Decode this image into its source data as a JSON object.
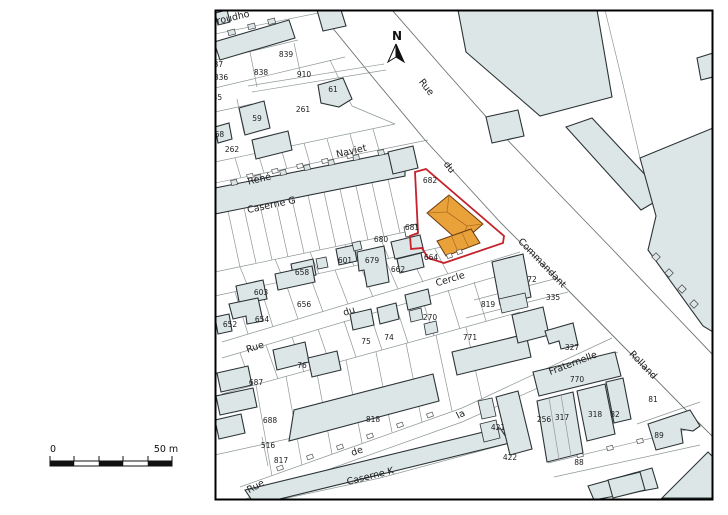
{
  "map": {
    "north_indicator": {
      "label": "N"
    },
    "scale_bar": {
      "zero_label": "0",
      "max_label": "50 m"
    },
    "colors": {
      "building_fill": "#dce6e6",
      "building_outline": "#2c3336",
      "parcel_line": "#8e9797",
      "road_line": "#6a7273",
      "highlight_red": "#c5222b",
      "orange_fill": "#e9a23a",
      "orange_line": "#b06f1e",
      "orange_outline": "#6b3a0e"
    },
    "streets": [
      {
        "name": "Proudho",
        "x": 231,
        "y": 21,
        "rot": -13
      },
      {
        "name": "Rue",
        "x": 424,
        "y": 89,
        "rot": 52
      },
      {
        "name": "du",
        "x": 447,
        "y": 169,
        "rot": 52
      },
      {
        "name": "Commandant",
        "x": 540,
        "y": 265,
        "rot": 46
      },
      {
        "name": "Rolland",
        "x": 641,
        "y": 367,
        "rot": 46
      },
      {
        "name": "René",
        "x": 260,
        "y": 182,
        "rot": -13
      },
      {
        "name": "Naviet",
        "x": 352,
        "y": 154,
        "rot": -13
      },
      {
        "name": "Caserne G",
        "x": 272,
        "y": 208,
        "rot": -12
      },
      {
        "name": "Rue",
        "x": 256,
        "y": 350,
        "rot": -18
      },
      {
        "name": "du",
        "x": 350,
        "y": 314,
        "rot": -18
      },
      {
        "name": "Cercle",
        "x": 451,
        "y": 282,
        "rot": -17
      },
      {
        "name": "Rue",
        "x": 257,
        "y": 489,
        "rot": -28
      },
      {
        "name": "de",
        "x": 358,
        "y": 454,
        "rot": -20
      },
      {
        "name": "la",
        "x": 462,
        "y": 417,
        "rot": -28
      },
      {
        "name": "Fraternelle",
        "x": 574,
        "y": 366,
        "rot": -21
      },
      {
        "name": "Caserne K",
        "x": 371,
        "y": 479,
        "rot": -14
      }
    ],
    "parcels": [
      {
        "num": "839",
        "x": 286,
        "y": 57
      },
      {
        "num": "837",
        "x": 216,
        "y": 67
      },
      {
        "num": "838",
        "x": 261,
        "y": 75
      },
      {
        "num": "910",
        "x": 304,
        "y": 77
      },
      {
        "num": "836",
        "x": 221,
        "y": 80
      },
      {
        "num": "835",
        "x": 215,
        "y": 100
      },
      {
        "num": "61",
        "x": 333,
        "y": 92
      },
      {
        "num": "261",
        "x": 303,
        "y": 112
      },
      {
        "num": "59",
        "x": 257,
        "y": 121
      },
      {
        "num": "568",
        "x": 217,
        "y": 137
      },
      {
        "num": "262",
        "x": 232,
        "y": 152
      },
      {
        "num": "682",
        "x": 430,
        "y": 183
      },
      {
        "num": "681",
        "x": 412,
        "y": 230
      },
      {
        "num": "680",
        "x": 381,
        "y": 242
      },
      {
        "num": "601",
        "x": 345,
        "y": 263
      },
      {
        "num": "679",
        "x": 372,
        "y": 263
      },
      {
        "num": "664",
        "x": 431,
        "y": 260
      },
      {
        "num": "662",
        "x": 398,
        "y": 272
      },
      {
        "num": "658",
        "x": 302,
        "y": 275
      },
      {
        "num": "72",
        "x": 532,
        "y": 282
      },
      {
        "num": "603",
        "x": 261,
        "y": 295
      },
      {
        "num": "335",
        "x": 553,
        "y": 300
      },
      {
        "num": "656",
        "x": 304,
        "y": 307
      },
      {
        "num": "819",
        "x": 488,
        "y": 307
      },
      {
        "num": "270",
        "x": 430,
        "y": 320
      },
      {
        "num": "654",
        "x": 262,
        "y": 322
      },
      {
        "num": "652",
        "x": 230,
        "y": 327
      },
      {
        "num": "74",
        "x": 389,
        "y": 340
      },
      {
        "num": "75",
        "x": 366,
        "y": 344
      },
      {
        "num": "771",
        "x": 470,
        "y": 340
      },
      {
        "num": "327",
        "x": 572,
        "y": 350
      },
      {
        "num": "76",
        "x": 302,
        "y": 368
      },
      {
        "num": "770",
        "x": 577,
        "y": 382
      },
      {
        "num": "687",
        "x": 256,
        "y": 385
      },
      {
        "num": "81",
        "x": 653,
        "y": 402
      },
      {
        "num": "318",
        "x": 595,
        "y": 417
      },
      {
        "num": "82",
        "x": 615,
        "y": 417
      },
      {
        "num": "317",
        "x": 562,
        "y": 420
      },
      {
        "num": "256",
        "x": 544,
        "y": 422
      },
      {
        "num": "818",
        "x": 373,
        "y": 422
      },
      {
        "num": "688",
        "x": 270,
        "y": 423
      },
      {
        "num": "421",
        "x": 498,
        "y": 430
      },
      {
        "num": "89",
        "x": 659,
        "y": 438
      },
      {
        "num": "516",
        "x": 268,
        "y": 448
      },
      {
        "num": "422",
        "x": 510,
        "y": 460
      },
      {
        "num": "817",
        "x": 281,
        "y": 463
      },
      {
        "num": "88",
        "x": 579,
        "y": 465
      }
    ]
  }
}
